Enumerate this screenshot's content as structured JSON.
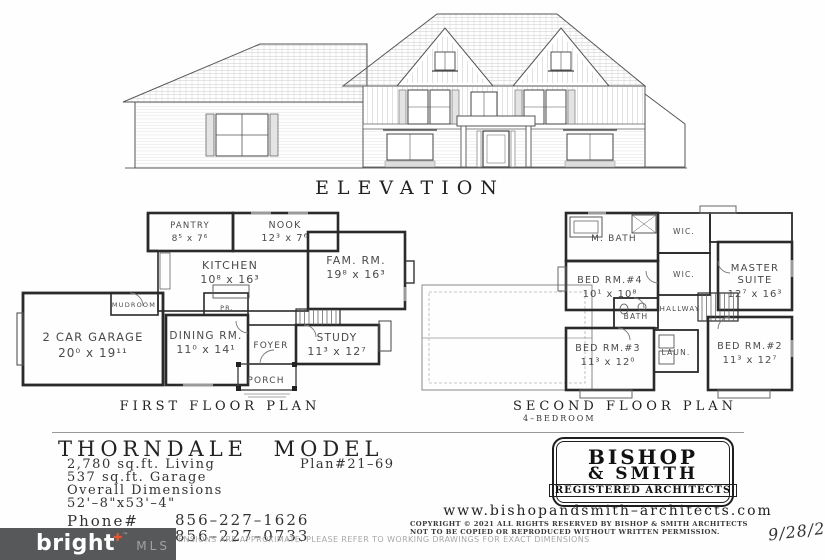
{
  "elevation": {
    "title": "ELEVATION"
  },
  "first_floor": {
    "title": "FIRST  FLOOR  PLAN",
    "rooms": [
      {
        "name": "PANTRY",
        "dims": "8⁵ x 7⁶"
      },
      {
        "name": "NOOK",
        "dims": "12³ x 7⁶"
      },
      {
        "name": "KITCHEN",
        "dims": "10⁸ x 16³"
      },
      {
        "name": "FAM. RM.",
        "dims": "19⁸ x 16³"
      },
      {
        "name": "MUDROOM",
        "dims": ""
      },
      {
        "name": "PR.",
        "dims": ""
      },
      {
        "name": "2 CAR GARAGE",
        "dims": "20⁰ x 19¹¹"
      },
      {
        "name": "DINING RM.",
        "dims": "11⁰ x 14¹"
      },
      {
        "name": "FOYER",
        "dims": ""
      },
      {
        "name": "STUDY",
        "dims": "11³ x 12⁷"
      },
      {
        "name": "PORCH",
        "dims": ""
      }
    ]
  },
  "second_floor": {
    "title": "SECOND  FLOOR  PLAN",
    "subtitle": "4–BEDROOM",
    "rooms": [
      {
        "name": "M. BATH",
        "dims": ""
      },
      {
        "name": "WIC.",
        "dims": ""
      },
      {
        "name": "WIC.",
        "dims": ""
      },
      {
        "name": "BED RM.#4",
        "dims": "10¹ x 10⁸"
      },
      {
        "name_line1": "MASTER",
        "name_line2": "SUITE",
        "dims": "12⁷ x 16³"
      },
      {
        "name": "HALLWAY",
        "dims": ""
      },
      {
        "name": "BATH",
        "dims": ""
      },
      {
        "name": "BED RM.#3",
        "dims": "11³ x 12⁰"
      },
      {
        "name": "LAUN.",
        "dims": ""
      },
      {
        "name": "BED RM.#2",
        "dims": "11³ x 12⁷"
      }
    ]
  },
  "title_block": {
    "model_name": "THORNDALE MODEL",
    "living": "2,780  sq.ft.  Living",
    "plan_no": "Plan#21–69",
    "garage": "537  sq.ft.  Garage",
    "overall_label": "Overall  Dimensions",
    "overall_dims": "52'–8\"x53'–4\"",
    "phone_label": "Phone#",
    "phone1": "856–227–1626",
    "phone2": "856–227–0733"
  },
  "architect": {
    "name_line1": "BISHOP",
    "name_line2": "& SMITH",
    "subtitle": "REGISTERED ARCHITECTS",
    "website": "www.bishopandsmith–architects.com",
    "copyright1": "COPYRIGHT © 2021  ALL  RIGHTS  RESERVED  BY  BISHOP  &  SMITH  ARCHITECTS",
    "copyright2": "NOT  TO  BE  COPIED  OR  REPRODUCED  WITHOUT  WRITTEN  PERMISSION.",
    "date": "9/28/2"
  },
  "footer": {
    "disclaimer": "ENSIONS ARE APPROXIMATE.  PLEASE REFER TO WORKING DRAWINGS FOR EXACT DIMENSIONS"
  },
  "watermark": {
    "brand": "bright",
    "accent": "✚",
    "tm": "™",
    "suffix": "MLS",
    "bg": "#57585a",
    "accent_color": "#e8552f"
  }
}
